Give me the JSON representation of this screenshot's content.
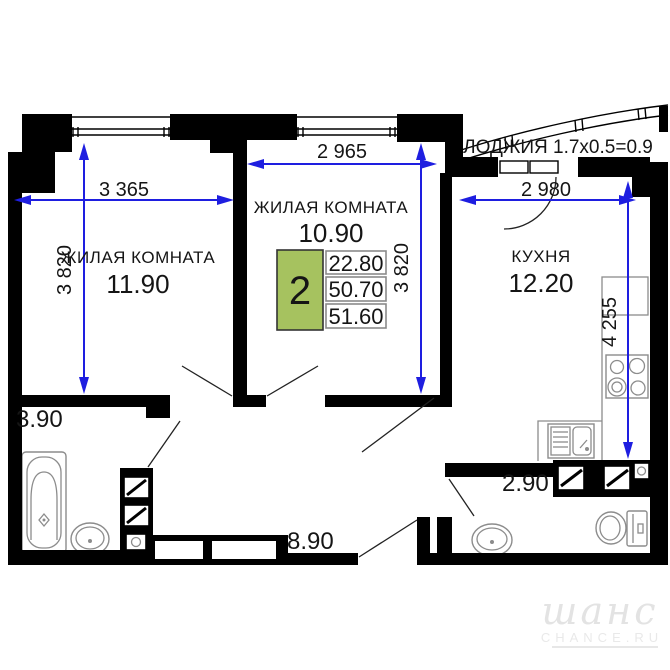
{
  "plan": {
    "room1": {
      "name": "ЖИЛАЯ КОМНАТА",
      "area": "11.90",
      "width_mm": "3 365",
      "height_mm": "3 820"
    },
    "room2": {
      "name": "ЖИЛАЯ КОМНАТА",
      "area": "10.90",
      "width_mm": "2 965",
      "height_mm": "3 820"
    },
    "kitchen": {
      "name": "КУХНЯ",
      "area": "12.20",
      "width_mm": "2 980",
      "height_mm": "4 255"
    },
    "loggia": {
      "label": "ЛОДЖИЯ 1.7x0.5=0.9"
    },
    "bathroom": {
      "area": "3.90"
    },
    "hallway": {
      "area": "8.90"
    },
    "wc": {
      "area": "2.90"
    }
  },
  "info_box": {
    "rooms_count": "2",
    "value_top": "22.80",
    "value_middle": "50.70",
    "value_bottom": "51.60"
  },
  "watermark": {
    "script": "шанс",
    "caption": "CHANCE.RU"
  },
  "colors": {
    "wall": "#000000",
    "dimension_blue": "#1e1ee0",
    "info_green": "#a6c25f",
    "fixture_gray": "#8c8c8c",
    "watermark_gray": "#e3e3e3"
  }
}
